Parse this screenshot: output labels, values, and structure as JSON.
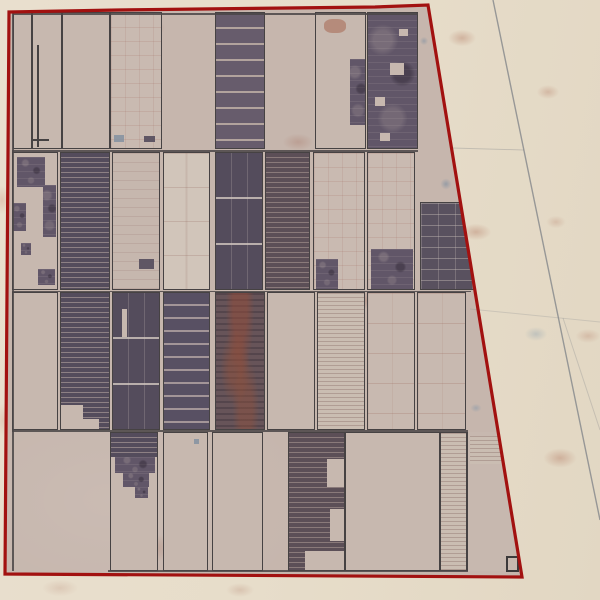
{
  "scene": {
    "type": "satellite-aerial-imagery",
    "subject": "farm-plot-block-with-survey-boundary",
    "colors": {
      "boundary_red": "#a21110",
      "plot_border_gray": "#464243",
      "field_light": "#c7b8af",
      "field_dark": "#5f5664",
      "desert_outside": "#e7ddca",
      "road_gray": "#84878b"
    }
  },
  "boundary": {
    "points": "9,12 118,10 375,7 428,5 522,577 5,574",
    "stroke": "#a21110",
    "stroke_width": 3.2
  },
  "roads": [
    {
      "x1": 493,
      "y1": 0,
      "x2": 600,
      "y2": 520,
      "w": 1.4,
      "o": 0.8
    },
    {
      "x1": 452,
      "y1": 148,
      "x2": 524,
      "y2": 150,
      "w": 1,
      "o": 0.35
    },
    {
      "x1": 563,
      "y1": 318,
      "x2": 600,
      "y2": 430,
      "w": 1,
      "o": 0.3
    },
    {
      "x1": 470,
      "y1": 309,
      "x2": 600,
      "y2": 322,
      "w": 1,
      "o": 0.25
    }
  ],
  "lines": [
    {
      "x": 13,
      "y": 13,
      "w": 405,
      "h": 1.5
    },
    {
      "x": 12,
      "y": 150,
      "w": 406,
      "h": 1.5
    },
    {
      "x": 12,
      "y": 290.5,
      "w": 459,
      "h": 1.5
    },
    {
      "x": 12,
      "y": 430,
      "w": 456,
      "h": 1.5
    },
    {
      "x": 108,
      "y": 570,
      "w": 360,
      "h": 1.5
    },
    {
      "x": 12,
      "y": 13,
      "w": 1.5,
      "h": 558
    }
  ],
  "plots": [
    {
      "x": 13,
      "y": 12,
      "w": 19,
      "h": 137,
      "f": "light"
    },
    {
      "x": 32,
      "y": 12,
      "w": 30,
      "h": 137,
      "f": "light",
      "patches": [
        {
          "x": 4,
          "y": 32,
          "w": 2,
          "h": 102,
          "f": "line"
        },
        {
          "x": 0,
          "y": 126,
          "w": 16,
          "h": 2,
          "f": "line"
        }
      ]
    },
    {
      "x": 62,
      "y": 12,
      "w": 48,
      "h": 137,
      "f": "light"
    },
    {
      "x": 110,
      "y": 12,
      "w": 52,
      "h": 137,
      "f": "light-grid",
      "patches": [
        {
          "x": 33,
          "y": 123,
          "w": 11,
          "h": 6,
          "f": "dark"
        },
        {
          "x": 3,
          "y": 122,
          "w": 10,
          "h": 7,
          "f": "blue"
        }
      ]
    },
    {
      "x": 215,
      "y": 12,
      "w": 50,
      "h": 137,
      "f": "dark-striped"
    },
    {
      "x": 315,
      "y": 12,
      "w": 51,
      "h": 137,
      "f": "light",
      "patches": [
        {
          "x": 34,
          "y": 46,
          "w": 16,
          "h": 66,
          "f": "dark-mottled"
        },
        {
          "x": 8,
          "y": 6,
          "w": 22,
          "h": 14,
          "f": "rust"
        }
      ]
    },
    {
      "x": 367,
      "y": 12,
      "w": 51,
      "h": 137,
      "f": "dark-mottled",
      "patches": [
        {
          "x": 22,
          "y": 50,
          "w": 14,
          "h": 12,
          "f": "light"
        },
        {
          "x": 7,
          "y": 84,
          "w": 10,
          "h": 9,
          "f": "light"
        },
        {
          "x": 31,
          "y": 16,
          "w": 9,
          "h": 7,
          "f": "light"
        },
        {
          "x": 12,
          "y": 120,
          "w": 10,
          "h": 8,
          "f": "light"
        }
      ]
    },
    {
      "x": 12,
      "y": 152,
      "w": 46,
      "h": 138,
      "f": "light",
      "patches": [
        {
          "x": 4,
          "y": 4,
          "w": 28,
          "h": 30,
          "f": "dark-mottled"
        },
        {
          "x": 0,
          "y": 50,
          "w": 13,
          "h": 28,
          "f": "dark-mottled"
        },
        {
          "x": 30,
          "y": 32,
          "w": 13,
          "h": 52,
          "f": "dark-mottled"
        },
        {
          "x": 25,
          "y": 116,
          "w": 17,
          "h": 16,
          "f": "dark-mottled"
        },
        {
          "x": 8,
          "y": 90,
          "w": 10,
          "h": 12,
          "f": "dark-mottled"
        }
      ]
    },
    {
      "x": 60,
      "y": 152,
      "w": 50,
      "h": 138,
      "f": "dark-striped-dense"
    },
    {
      "x": 112,
      "y": 152,
      "w": 48,
      "h": 138,
      "f": "light-lines-faint",
      "patches": [
        {
          "x": 26,
          "y": 106,
          "w": 15,
          "h": 10,
          "f": "dark"
        }
      ]
    },
    {
      "x": 163,
      "y": 152,
      "w": 47,
      "h": 138,
      "f": "cream-lines"
    },
    {
      "x": 215,
      "y": 152,
      "w": 48,
      "h": 138,
      "f": "dark-dashrows"
    },
    {
      "x": 265,
      "y": 152,
      "w": 45,
      "h": 138,
      "f": "dark-striped-dense2"
    },
    {
      "x": 313,
      "y": 152,
      "w": 52,
      "h": 138,
      "f": "light-grid",
      "patches": [
        {
          "x": 2,
          "y": 106,
          "w": 22,
          "h": 30,
          "f": "dark-mottled"
        }
      ]
    },
    {
      "x": 367,
      "y": 152,
      "w": 48,
      "h": 138,
      "f": "light-grid",
      "patches": [
        {
          "x": 3,
          "y": 96,
          "w": 42,
          "h": 40,
          "f": "dark-mottled"
        }
      ]
    },
    {
      "x": 420,
      "y": 202,
      "w": 55,
      "h": 88,
      "f": "dark-grid"
    },
    {
      "x": 12,
      "y": 292,
      "w": 46,
      "h": 138,
      "f": "light"
    },
    {
      "x": 60,
      "y": 292,
      "w": 50,
      "h": 138,
      "f": "dark-striped-dense",
      "patches": [
        {
          "x": 0,
          "y": 112,
          "w": 22,
          "h": 26,
          "f": "light"
        },
        {
          "x": 22,
          "y": 126,
          "w": 16,
          "h": 12,
          "f": "light"
        }
      ]
    },
    {
      "x": 112,
      "y": 292,
      "w": 48,
      "h": 138,
      "f": "dark-dashrows",
      "patches": [
        {
          "x": 9,
          "y": 16,
          "w": 5,
          "h": 28,
          "f": "light"
        }
      ]
    },
    {
      "x": 163,
      "y": 292,
      "w": 47,
      "h": 138,
      "f": "dark-striped-wide"
    },
    {
      "x": 215,
      "y": 292,
      "w": 50,
      "h": 138,
      "f": "dark-rusty"
    },
    {
      "x": 267,
      "y": 292,
      "w": 48,
      "h": 138,
      "f": "light"
    },
    {
      "x": 317,
      "y": 292,
      "w": 48,
      "h": 138,
      "f": "light-ruled"
    },
    {
      "x": 367,
      "y": 292,
      "w": 48,
      "h": 138,
      "f": "light-dotrows"
    },
    {
      "x": 417,
      "y": 292,
      "w": 49,
      "h": 138,
      "f": "light-dotrows"
    },
    {
      "x": 110,
      "y": 432,
      "w": 48,
      "h": 139,
      "f": "light",
      "patches": [
        {
          "x": 0,
          "y": 0,
          "w": 48,
          "h": 24,
          "f": "dark-striped-dense"
        },
        {
          "x": 4,
          "y": 24,
          "w": 40,
          "h": 16,
          "f": "dark-mottled"
        },
        {
          "x": 12,
          "y": 40,
          "w": 26,
          "h": 14,
          "f": "dark-mottled"
        },
        {
          "x": 24,
          "y": 54,
          "w": 13,
          "h": 11,
          "f": "dark-mottled"
        }
      ]
    },
    {
      "x": 163,
      "y": 432,
      "w": 45,
      "h": 139,
      "f": "light",
      "patches": [
        {
          "x": 30,
          "y": 6,
          "w": 5,
          "h": 5,
          "f": "blue"
        }
      ]
    },
    {
      "x": 212,
      "y": 432,
      "w": 51,
      "h": 139,
      "f": "light"
    },
    {
      "x": 288,
      "y": 432,
      "w": 57,
      "h": 139,
      "f": "dark-striped-dense2",
      "patches": [
        {
          "x": 38,
          "y": 26,
          "w": 19,
          "h": 28,
          "f": "light"
        },
        {
          "x": 41,
          "y": 76,
          "w": 16,
          "h": 32,
          "f": "light"
        },
        {
          "x": 16,
          "y": 118,
          "w": 41,
          "h": 21,
          "f": "light"
        }
      ]
    },
    {
      "x": 345,
      "y": 432,
      "w": 95,
      "h": 139,
      "f": "light"
    },
    {
      "x": 440,
      "y": 432,
      "w": 27,
      "h": 139,
      "f": "light-ruled"
    },
    {
      "x": 467,
      "y": 432,
      "w": 46,
      "h": 139,
      "f": "light",
      "b": "left",
      "patches": [
        {
          "x": 2,
          "y": 4,
          "w": 38,
          "h": 28,
          "f": "light-ruled"
        }
      ]
    },
    {
      "x": 506,
      "y": 556,
      "w": 13,
      "h": 16,
      "f": "light",
      "b": "thick"
    }
  ]
}
